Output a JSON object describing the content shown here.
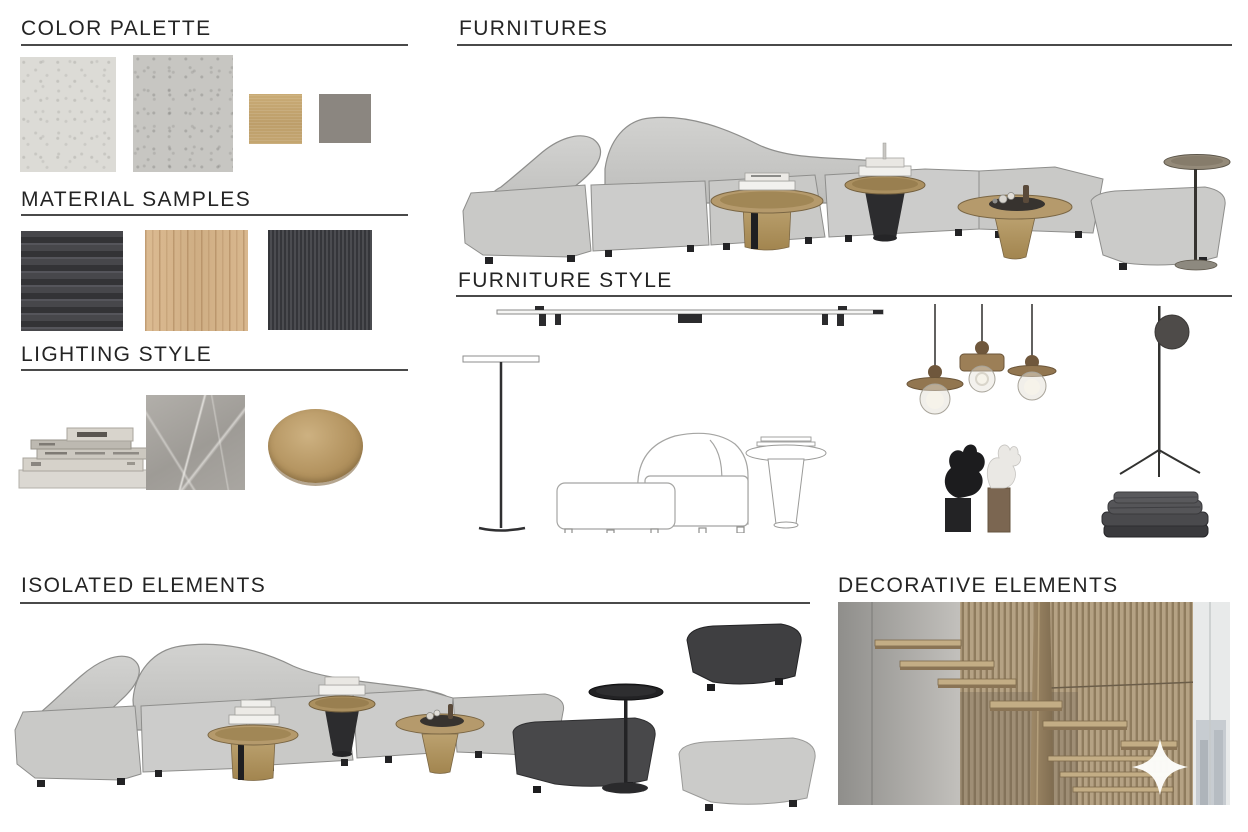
{
  "sections": {
    "color_palette": {
      "title": "COLOR PALETTE",
      "swatches": [
        {
          "name": "light-plaster",
          "color": "#dcdbd6"
        },
        {
          "name": "gray-plaster",
          "color": "#c7c6c2"
        },
        {
          "name": "brushed-brass",
          "color": "#c2a471"
        },
        {
          "name": "gunmetal-bronze",
          "color": "#8b8680"
        }
      ]
    },
    "material_samples": {
      "title": "MATERIAL SAMPLES",
      "swatches": [
        {
          "name": "charcoal-striped-fabric",
          "color": "#3d3d40"
        },
        {
          "name": "oak-veneer",
          "color": "#d5b38a"
        },
        {
          "name": "charcoal-ribbed-fabric",
          "color": "#3f4043"
        }
      ]
    },
    "lighting_style": {
      "title": "LIGHTING STYLE",
      "items": [
        {
          "name": "book-stack",
          "color": "#d6d2ca"
        },
        {
          "name": "gray-marble",
          "color": "#a8a5a0"
        },
        {
          "name": "brass-disc",
          "color": "#b3956a"
        }
      ]
    },
    "furnitures": {
      "title": "FURNITURES",
      "items": [
        {
          "name": "curved-modular-sofa",
          "color": "#cbcbc9"
        },
        {
          "name": "round-gold-side-tables",
          "color": "#b59a6c"
        },
        {
          "name": "black-pedestal-table",
          "color": "#2d2d2f"
        },
        {
          "name": "stem-side-table",
          "color": "#948a79"
        }
      ]
    },
    "furniture_style": {
      "title": "FURNITURE STYLE",
      "items": [
        {
          "name": "track-light",
          "color": "#2b2b2d"
        },
        {
          "name": "floor-lamp-sketch"
        },
        {
          "name": "modular-chair-sketch"
        },
        {
          "name": "pedestal-table-sketch"
        },
        {
          "name": "wood-pendant-lights",
          "color": "#97764f"
        },
        {
          "name": "abstract-sculptures",
          "color": "#1d1d1f"
        },
        {
          "name": "disc-floor-lamp",
          "color": "#4c4a48"
        },
        {
          "name": "folded-blankets",
          "color": "#4a4a4d"
        }
      ]
    },
    "isolated_elements": {
      "title": "ISOLATED ELEMENTS",
      "items": [
        {
          "name": "curved-modular-sofa",
          "color": "#cbcbc9"
        },
        {
          "name": "dark-ottoman",
          "color": "#474749"
        },
        {
          "name": "light-ottoman",
          "color": "#cbcbc9"
        },
        {
          "name": "black-stem-table",
          "color": "#242426"
        }
      ]
    },
    "decorative_elements": {
      "title": "DECORATIVE ELEMENTS",
      "items": [
        {
          "name": "slatted-staircase-photo",
          "concrete_color": "#a5a3a0",
          "wood_color": "#b3a084"
        },
        {
          "name": "sparkle-watermark",
          "color": "#ffffff"
        }
      ]
    }
  }
}
